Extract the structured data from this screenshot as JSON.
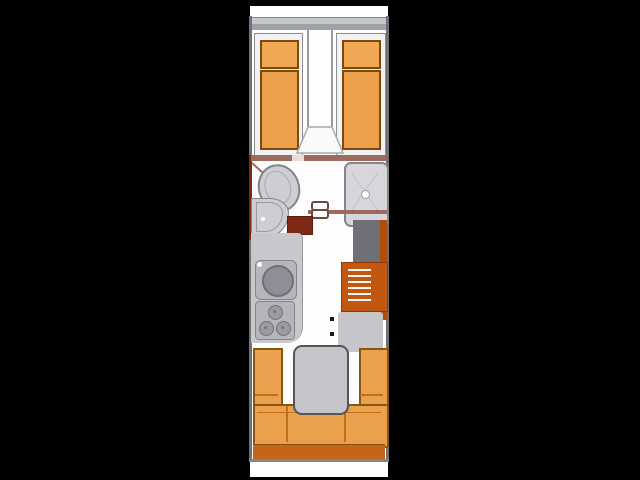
{
  "image": {
    "kind": "floorplan",
    "subject": "caravan-layout-top-view",
    "orientation": "vertical",
    "visible_text": []
  },
  "colors": {
    "background": "#000000",
    "floor_white": "#fdfdfd",
    "outer_band_grey": "#9ba2a9",
    "wall_grey": "#6e7076",
    "wall_brown": "#9c6b5e",
    "wall_red": "#7e2916",
    "bed_frame": "#f2f2f4",
    "bed_border": "#8d8d93",
    "cushion_orange": "#eda04b",
    "pillow_orange": "#f1a855",
    "cushion_border": "#7a4a10",
    "fixture_grey": "#cdced2",
    "fixture_border": "#85858b",
    "counter_grey": "#c8c8cc",
    "appliance_grey": "#b5b5bb",
    "basin_grey": "#8e8e96",
    "wardrobe_grey": "#6f6f77",
    "heater_orange": "#c2570f",
    "heater_dark": "#8e3a05",
    "door_orange": "#b34c09",
    "lounge_orange": "#e9a14d",
    "lounge_border": "#8a5510",
    "lounge_seam": "#c07018",
    "lounge_strip": "#c4661a",
    "table_grey": "#c6c6ca",
    "table_border": "#55555a"
  },
  "areas": [
    {
      "id": "bedroom",
      "kind": "twin-single-beds",
      "position": "front"
    },
    {
      "id": "washroom",
      "kind": "bathroom",
      "position": "middle-front"
    },
    {
      "id": "kitchen",
      "kind": "galley-kitchen",
      "position": "middle-rear"
    },
    {
      "id": "lounge",
      "kind": "u-shaped-seating",
      "position": "rear"
    }
  ],
  "fixtures": [
    {
      "id": "bed-left",
      "kind": "single-bed-with-pillow"
    },
    {
      "id": "bed-right",
      "kind": "single-bed-with-pillow"
    },
    {
      "id": "walkway",
      "kind": "center-aisle-step"
    },
    {
      "id": "toilet",
      "kind": "toilet"
    },
    {
      "id": "washbasin",
      "kind": "corner-washbasin"
    },
    {
      "id": "shower",
      "kind": "shower-tray-with-drain"
    },
    {
      "id": "door-latch",
      "kind": "door-handle"
    },
    {
      "id": "kitchen-sink",
      "kind": "round-bowl-sink"
    },
    {
      "id": "hob",
      "kind": "three-burner-hob"
    },
    {
      "id": "wardrobe",
      "kind": "wardrobe"
    },
    {
      "id": "heater",
      "kind": "vented-heater"
    },
    {
      "id": "entry-door",
      "kind": "side-entry-door"
    },
    {
      "id": "lounge-bench-left",
      "kind": "seat-cushion"
    },
    {
      "id": "lounge-bench-right",
      "kind": "seat-cushion"
    },
    {
      "id": "lounge-bench-rear",
      "kind": "seat-cushion"
    },
    {
      "id": "table",
      "kind": "pedestal-table"
    },
    {
      "id": "rear-shelf",
      "kind": "rear-backrest-shelf"
    }
  ]
}
